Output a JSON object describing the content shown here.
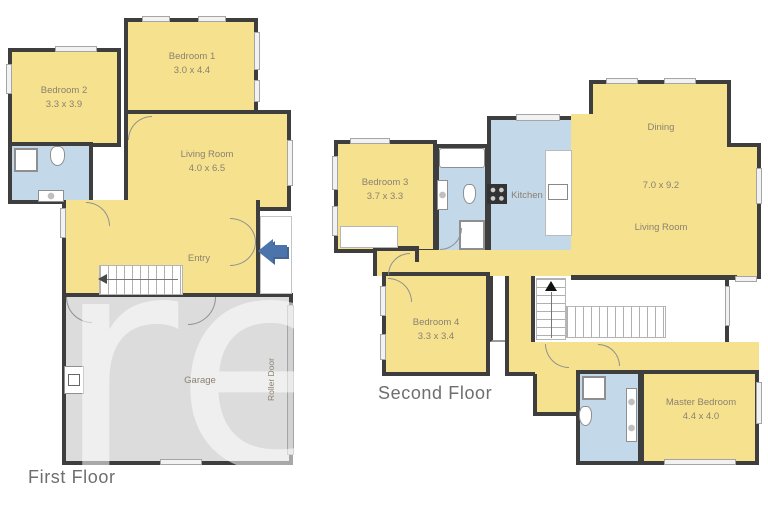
{
  "watermark": {
    "text": "re"
  },
  "first_floor": {
    "label": "First Floor",
    "bedroom2": {
      "name": "Bedroom 2",
      "dims": "3.3 x 3.9"
    },
    "bedroom1": {
      "name": "Bedroom 1",
      "dims": "3.0 x 4.4"
    },
    "living_room": {
      "name": "Living Room",
      "dims": "4.0 x 6.5"
    },
    "entry": {
      "name": "Entry"
    },
    "garage": {
      "name": "Garage"
    },
    "roller_door_label": "Roller Door"
  },
  "second_floor": {
    "label": "Second Floor",
    "bedroom3": {
      "name": "Bedroom 3",
      "dims": "3.7 x 3.3"
    },
    "kitchen": {
      "name": "Kitchen"
    },
    "dining": {
      "name": "Dining"
    },
    "living_dining_dims": "7.0 x 9.2",
    "living_room": {
      "name": "Living Room"
    },
    "bedroom4": {
      "name": "Bedroom 4",
      "dims": "3.3 x 3.4"
    },
    "master_bedroom": {
      "name": "Master Bedroom",
      "dims": "4.4 x 4.0"
    }
  },
  "colors": {
    "room_fill": "#f6e28e",
    "wet_area_fill": "#c3d8e8",
    "garage_fill": "#dcdcdc",
    "wall": "#3e3e3e",
    "entry_arrow": "#4a74ab",
    "label_text": "#8a8171",
    "floor_label_text": "#6e6e6e"
  }
}
